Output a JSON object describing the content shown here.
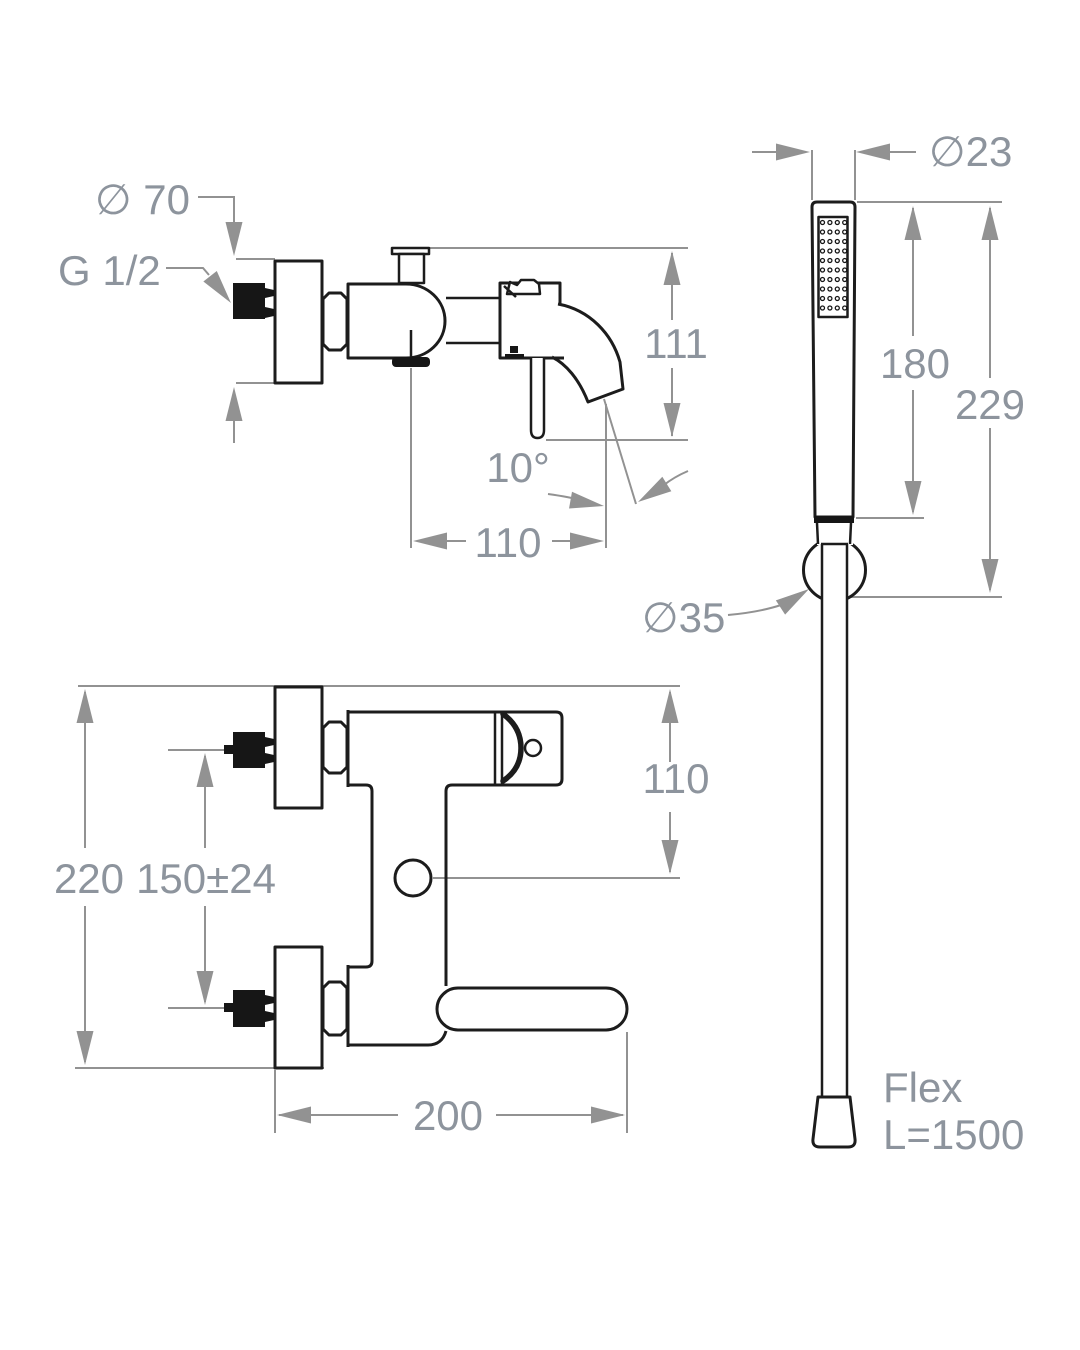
{
  "side_view": {
    "flange_diameter": "∅ 70",
    "thread_label": "G 1/2",
    "height_dim": "111",
    "angle_dim": "10°",
    "reach_dim": "110"
  },
  "hand_shower": {
    "head_diameter": "∅23",
    "head_length": "180",
    "total_length": "229",
    "bracket_diameter": "∅35",
    "hose_label_line1": "Flex",
    "hose_label_line2": "L=1500"
  },
  "front_view": {
    "overall_height": "220",
    "inlet_spacing": "150±24",
    "top_to_axis": "110",
    "spout_reach": "200"
  },
  "colors": {
    "outline": "#1c1c1c",
    "dimension_lines": "#929292",
    "dimension_text": "#8d949d"
  }
}
